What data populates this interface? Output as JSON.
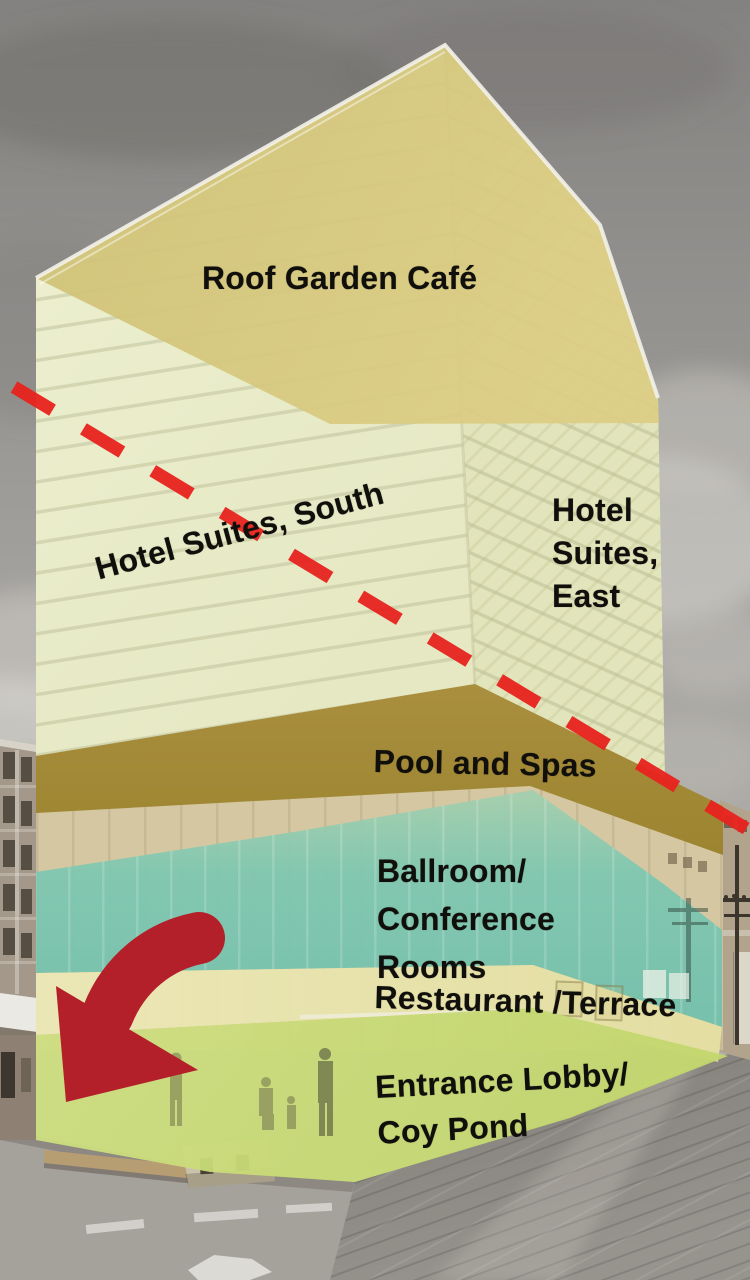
{
  "figure": {
    "type": "annotated-building-cutaway-diagram",
    "subject": "Hotel tower photo with color-coded floor zones, a red dashed section-cut line and a red arrow pointing to the entrance"
  },
  "zones": [
    {
      "id": "roof-garden-cafe",
      "label": "Roof Garden Café",
      "color": "#d6c77c"
    },
    {
      "id": "hotel-suites-south",
      "label": "Hotel Suites, South",
      "color": "#e8eac7"
    },
    {
      "id": "hotel-suites-east",
      "lines": [
        "Hotel",
        "Suites,",
        "East"
      ],
      "color": "#e2e5bb"
    },
    {
      "id": "pool-and-spas",
      "label": "Pool and Spas",
      "color": "#a88e3c"
    },
    {
      "id": "ballroom-conference",
      "lines": [
        "Ballroom/",
        "Conference",
        "Rooms"
      ],
      "color": "#7fc7b1"
    },
    {
      "id": "restaurant-terrace",
      "label": "Restaurant /Terrace",
      "color": "#ebe7b4"
    },
    {
      "id": "entrance-lobby-coy-pond",
      "lines": [
        "Entrance Lobby/",
        "Coy Pond"
      ],
      "color": "#cbdc78"
    }
  ],
  "annotations": {
    "cut_line_color": "#e8231f",
    "arrow_color": "#b4202a",
    "text_color": "#100f0c"
  }
}
